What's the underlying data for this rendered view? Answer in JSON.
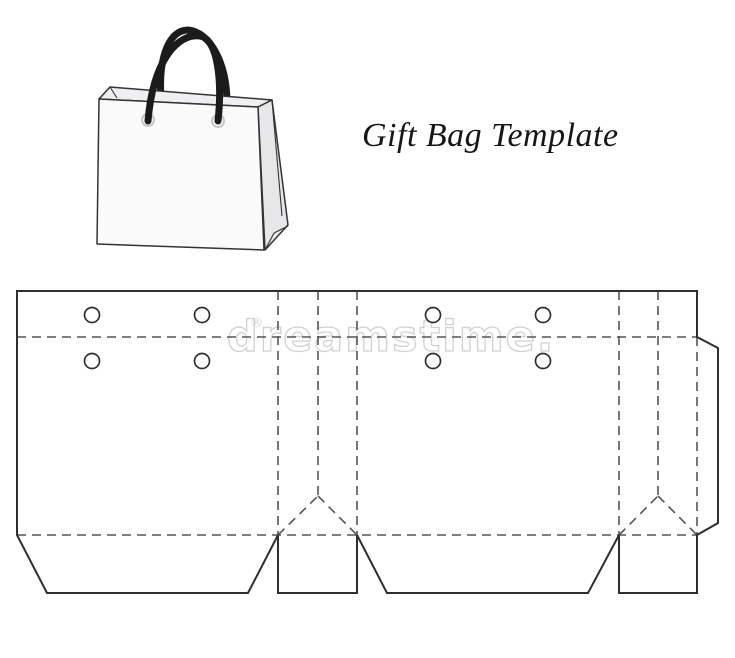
{
  "page": {
    "title_label": "Gift Bag Template"
  },
  "watermark": {
    "text": "dreamstime.",
    "reg": "®"
  },
  "colors": {
    "cut_line": "#2f2f2f",
    "fold_line": "#555555",
    "watermark": "#c9c9c9",
    "watermark_reg": "#cfcfcf",
    "handle": "#1b1b1b",
    "bag_outline": "#333333",
    "bag_front_fill": "#fafafa",
    "bag_side_fill": "#e7e7ea",
    "bag_rim_fill": "#efeff1",
    "hole_fill": "#ffffff",
    "grommet_ring": "#c4c4c8"
  },
  "bag": {
    "handle_width": 7,
    "back_handle": "M 161,99 C 158,55 170,30 188,30 C 210,32 226,62 227,100",
    "front_handle": "M 148,121 C 153,60 178,33 200,36 C 219,40 222,85 218,121",
    "faces": [
      {
        "name": "bag-top-rim",
        "points": [
          [
            99,
            99
          ],
          [
            110,
            87
          ],
          [
            272,
            100
          ],
          [
            258,
            107
          ]
        ],
        "fill_key": "bag_rim_fill"
      },
      {
        "name": "bag-side-face",
        "points": [
          [
            258,
            107
          ],
          [
            272,
            100
          ],
          [
            288,
            225
          ],
          [
            265,
            250
          ]
        ],
        "fill_key": "bag_side_fill"
      },
      {
        "name": "bag-front-face",
        "points": [
          [
            99,
            99
          ],
          [
            258,
            107
          ],
          [
            264,
            250
          ],
          [
            97,
            244
          ]
        ],
        "fill_key": "bag_front_fill"
      }
    ],
    "detail_lines": [
      [
        110,
        87,
        117,
        98
      ],
      [
        272,
        100,
        282,
        216
      ],
      [
        265,
        250,
        274,
        233
      ],
      [
        274,
        233,
        288,
        226
      ]
    ],
    "grommets": [
      [
        148,
        120,
        6
      ],
      [
        218,
        121,
        6
      ]
    ]
  },
  "diagram": {
    "outline": [
      [
        17,
        291
      ],
      [
        697,
        291
      ],
      [
        697,
        337
      ],
      [
        718,
        348
      ],
      [
        718,
        523
      ],
      [
        697,
        535
      ],
      [
        697,
        593
      ],
      [
        619,
        593
      ],
      [
        619,
        535
      ],
      [
        588,
        593
      ],
      [
        387,
        593
      ],
      [
        357,
        535
      ],
      [
        357,
        593
      ],
      [
        278,
        593
      ],
      [
        278,
        535
      ],
      [
        248,
        593
      ],
      [
        47,
        593
      ],
      [
        17,
        535
      ]
    ],
    "fold_lines": [
      [
        17,
        337,
        697,
        337
      ],
      [
        17,
        535,
        697,
        535
      ],
      [
        278,
        291,
        278,
        535
      ],
      [
        318,
        291,
        318,
        496
      ],
      [
        357,
        291,
        357,
        535
      ],
      [
        619,
        291,
        619,
        535
      ],
      [
        658,
        291,
        658,
        496
      ],
      [
        697,
        337,
        697,
        535
      ],
      [
        278,
        535,
        318,
        496
      ],
      [
        318,
        496,
        357,
        535
      ],
      [
        619,
        535,
        658,
        496
      ],
      [
        658,
        496,
        697,
        535
      ]
    ],
    "holes": [
      [
        92,
        315
      ],
      [
        202,
        315
      ],
      [
        92,
        361
      ],
      [
        202,
        361
      ],
      [
        433,
        315
      ],
      [
        543,
        315
      ],
      [
        433,
        361
      ],
      [
        543,
        361
      ]
    ],
    "hole_radius": 7.5
  }
}
